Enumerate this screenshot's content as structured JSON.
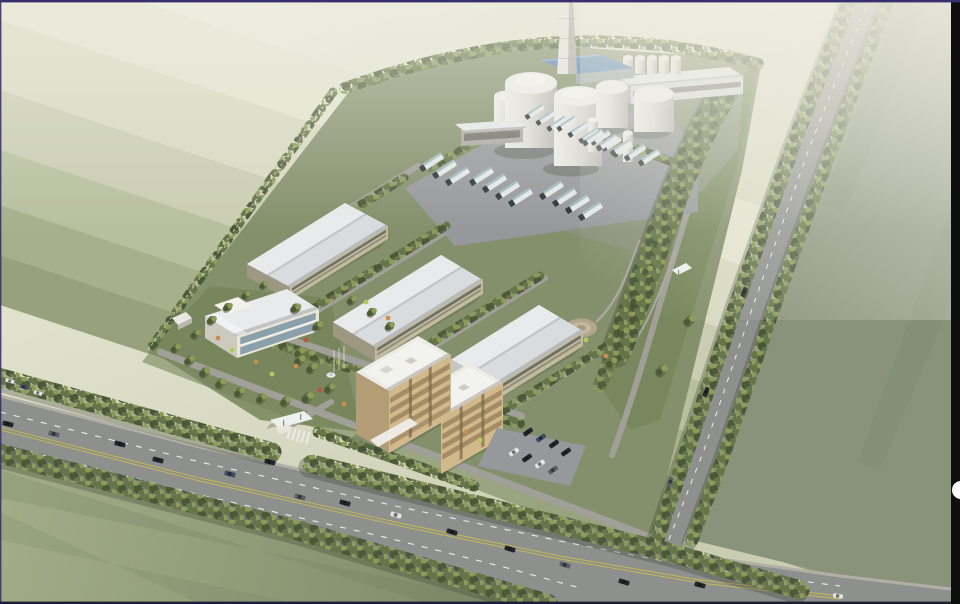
{
  "meta": {
    "scene": "aerial architectural rendering of an industrial campus beside farmland",
    "view": "bird's-eye axonometric, daytime haze toward the top"
  },
  "palette": {
    "band_1": "#efeedf",
    "band_2": "#e5e5d1",
    "band_3": "#d8dac2",
    "band_4": "#c9cdb1",
    "band_5": "#b8bf9e",
    "band_6": "#a6b08b",
    "band_7": "#97a27c",
    "field_right": "#89937c",
    "field_bl_light": "#a3ad88",
    "field_bl_dark": "#7c8968",
    "site": "#84906c",
    "garden": "#75855a",
    "apron": "#8b927c",
    "road": "#8e908e",
    "road_inner": "#a0a099",
    "curb": "#b2b0a6",
    "mark_white": "#edeeea",
    "mark_yellow": "#c9ba50",
    "parking": "#96989c",
    "tree_dark": "#4b5937",
    "tree_mid": "#657549",
    "tree_light": "#8c9b57",
    "tree_pale": "#aab26b",
    "tree_shadow": "#37412e",
    "roof_white": "#d9dcde",
    "roof_bright": "#e8eaeb",
    "roof_edge": "#b7babc",
    "wall_beige": "#c1ba9f",
    "win_dark": "#62625a",
    "tower_wall": "#d2b98c",
    "tower_accent": "#7d6747",
    "tower_roof": "#ecebe5",
    "tower_roof_shade": "#c8c6be",
    "white_wall": "#e9e6d9",
    "glass": "#8aa0aa",
    "tank_body": "#dfdfd9",
    "tank_shade": "#b4b5ae",
    "tank_top": "#efefec",
    "blue_roof": "#5480b4",
    "chim_light": "#e6e6e2",
    "chim_shade": "#aeafab",
    "truck_trailer": "#e3e8ea",
    "truck_teal": "#9cb9c0",
    "truck_cab": "#2c3336",
    "plaza": "#b2a78e",
    "path_c": "#a8a89e",
    "fence_c": "#d9d7ca",
    "shadow_c": "#2f3a2a",
    "purple": "#38306e",
    "strip": "#0e0e0e",
    "navw": "#ffffff",
    "bottom_bar": "#201d36"
  },
  "scene_objects": {
    "chimneys": 1,
    "large_storage_tanks": 5,
    "slim_silos": 2,
    "rooftop_silos": 5,
    "blue_roof_plant_building": 1,
    "long_process_building": 1,
    "warehouses": 3,
    "office_tower_blocks": 2,
    "admin_building": 1,
    "gatehouses": 2,
    "guard_post": 1,
    "fountain": 1,
    "circular_plaza": 1,
    "tanker_trucks": 25,
    "road_vehicles": 20,
    "parked_cars": 8
  },
  "viewer": {
    "top_border": "thin purple rule",
    "right_strip": "black vertical strip",
    "nav_button": "white half-circle page button",
    "bottom_border": "thin dark rule"
  },
  "instances": [
    {
      "ref": "truck",
      "name": "tanker-truck",
      "items": [
        [
          531,
          114,
          -33,
          0.82
        ],
        [
          542,
          120,
          -33,
          0.82
        ],
        [
          553,
          126,
          -33,
          0.82
        ],
        [
          563,
          126,
          -33,
          0.82
        ],
        [
          574,
          132,
          -33,
          0.82
        ],
        [
          585,
          138,
          -33,
          0.82
        ],
        [
          597,
          140,
          -33,
          0.82
        ],
        [
          608,
          146,
          -33,
          0.82
        ],
        [
          619,
          152,
          -33,
          0.82
        ],
        [
          427,
          165,
          -33,
          1
        ],
        [
          440,
          172,
          -33,
          1
        ],
        [
          453,
          179,
          -33,
          1
        ],
        [
          477,
          179,
          -33,
          1
        ],
        [
          490,
          186,
          -33,
          1
        ],
        [
          503,
          193,
          -33,
          1
        ],
        [
          516,
          200,
          -33,
          1
        ],
        [
          547,
          193,
          -33,
          1
        ],
        [
          560,
          200,
          -33,
          1
        ],
        [
          573,
          207,
          -33,
          1
        ],
        [
          586,
          214,
          -33,
          1
        ],
        [
          589,
          140,
          -33,
          0.9
        ],
        [
          603,
          145,
          -33,
          0.9
        ],
        [
          617,
          150,
          -33,
          0.9
        ],
        [
          631,
          155,
          -33,
          0.9
        ],
        [
          645,
          160,
          -33,
          0.9
        ]
      ]
    },
    {
      "ref": "car",
      "name": "car",
      "items": [
        [
          8,
          424,
          14,
          1,
          "v-dark"
        ],
        [
          54,
          434,
          14,
          1,
          "v-gray"
        ],
        [
          120,
          444,
          14,
          1,
          "v-dark"
        ],
        [
          158,
          460,
          15,
          1,
          "v-dark"
        ],
        [
          230,
          474,
          15,
          1,
          "v-blue"
        ],
        [
          270,
          462,
          15,
          1,
          "v-dark"
        ],
        [
          300,
          497,
          16,
          1,
          "v-gray"
        ],
        [
          345,
          503,
          16,
          1,
          "v-dark"
        ],
        [
          396,
          515,
          16,
          1,
          "v-white"
        ],
        [
          452,
          532,
          17,
          1,
          "v-dark"
        ],
        [
          510,
          549,
          17,
          1,
          "v-dark"
        ],
        [
          565,
          565,
          17,
          1,
          "v-gray"
        ],
        [
          624,
          582,
          17,
          1,
          "v-dark"
        ],
        [
          700,
          585,
          14,
          1,
          "v-dark"
        ],
        [
          838,
          596,
          10,
          0.9,
          "v-white"
        ],
        [
          744,
          292,
          112,
          0.9,
          "v-dark"
        ],
        [
          706,
          392,
          112,
          0.9,
          "v-dark"
        ],
        [
          670,
          482,
          112,
          0.9,
          "v-gray"
        ],
        [
          10,
          381,
          16,
          0.8,
          "v-white"
        ],
        [
          24,
          387,
          16,
          0.8,
          "v-blue"
        ],
        [
          38,
          393,
          16,
          0.8,
          "v-white"
        ],
        [
          528,
          432,
          -35,
          0.95,
          "v-dark"
        ],
        [
          541,
          438,
          -35,
          0.95,
          "v-blue"
        ],
        [
          554,
          444,
          -35,
          0.95,
          "v-dark"
        ],
        [
          514,
          452,
          -35,
          0.95,
          "v-white"
        ],
        [
          527,
          458,
          -35,
          0.95,
          "v-dark"
        ],
        [
          540,
          464,
          -35,
          0.95,
          "v-white"
        ],
        [
          553,
          470,
          -35,
          0.95,
          "v-gray"
        ],
        [
          566,
          452,
          -35,
          0.95,
          "v-dark"
        ]
      ]
    },
    {
      "ref": "tree",
      "name": "garden-tree",
      "items": [
        [
          176,
          348,
          0,
          0.9
        ],
        [
          190,
          360,
          0,
          1
        ],
        [
          205,
          372,
          0,
          1
        ],
        [
          221,
          383,
          0,
          1
        ],
        [
          240,
          392,
          0,
          1
        ],
        [
          262,
          398,
          0,
          1
        ],
        [
          286,
          401,
          0,
          1
        ],
        [
          308,
          397,
          0,
          1.1
        ],
        [
          330,
          388,
          0,
          1
        ],
        [
          196,
          334,
          0,
          0.9
        ],
        [
          212,
          320,
          0,
          0.9
        ],
        [
          228,
          307,
          0,
          0.9
        ],
        [
          246,
          295,
          0,
          0.8
        ],
        [
          264,
          285,
          0,
          0.8
        ],
        [
          296,
          308,
          0,
          1
        ],
        [
          318,
          326,
          0,
          1
        ],
        [
          300,
          352,
          0,
          1
        ],
        [
          352,
          300,
          0,
          0.9
        ],
        [
          372,
          312,
          0,
          0.9
        ],
        [
          390,
          326,
          0,
          0.9
        ],
        [
          300,
          360,
          0,
          1
        ],
        [
          312,
          368,
          0,
          1
        ],
        [
          612,
          362,
          0,
          1
        ],
        [
          624,
          332,
          0,
          1
        ],
        [
          636,
          300,
          0,
          1
        ],
        [
          648,
          270,
          0,
          1
        ],
        [
          658,
          242,
          0,
          0.9
        ],
        [
          668,
          214,
          0,
          0.9
        ],
        [
          680,
          186,
          0,
          0.9
        ],
        [
          692,
          158,
          0,
          0.8
        ],
        [
          702,
          130,
          0,
          0.8
        ],
        [
          714,
          104,
          0,
          0.8
        ],
        [
          690,
          320,
          0,
          1.1
        ],
        [
          662,
          370,
          0,
          1.1
        ]
      ]
    },
    {
      "ref": "shrub",
      "name": "flowering-shrub",
      "items": [
        [
          256,
          362,
          0,
          1,
          "v-orange"
        ],
        [
          272,
          374,
          0,
          1,
          "v-lime"
        ],
        [
          296,
          366,
          0,
          1,
          "v-orange"
        ],
        [
          232,
          350,
          0,
          1,
          "v-lime"
        ],
        [
          320,
          390,
          0,
          1,
          "v-red"
        ],
        [
          344,
          404,
          0,
          1,
          "v-orange"
        ],
        [
          366,
          302,
          0,
          1,
          "v-lime"
        ],
        [
          388,
          318,
          0,
          1,
          "v-orange"
        ],
        [
          306,
          340,
          0,
          1,
          "v-red"
        ],
        [
          218,
          338,
          0,
          1,
          "v-orange"
        ],
        [
          480,
          440,
          0,
          1,
          "v-lime"
        ],
        [
          466,
          432,
          0,
          1,
          "v-orange"
        ],
        [
          586,
          340,
          0,
          1,
          "v-lime"
        ],
        [
          606,
          356,
          0,
          1,
          "v-orange"
        ]
      ]
    }
  ]
}
